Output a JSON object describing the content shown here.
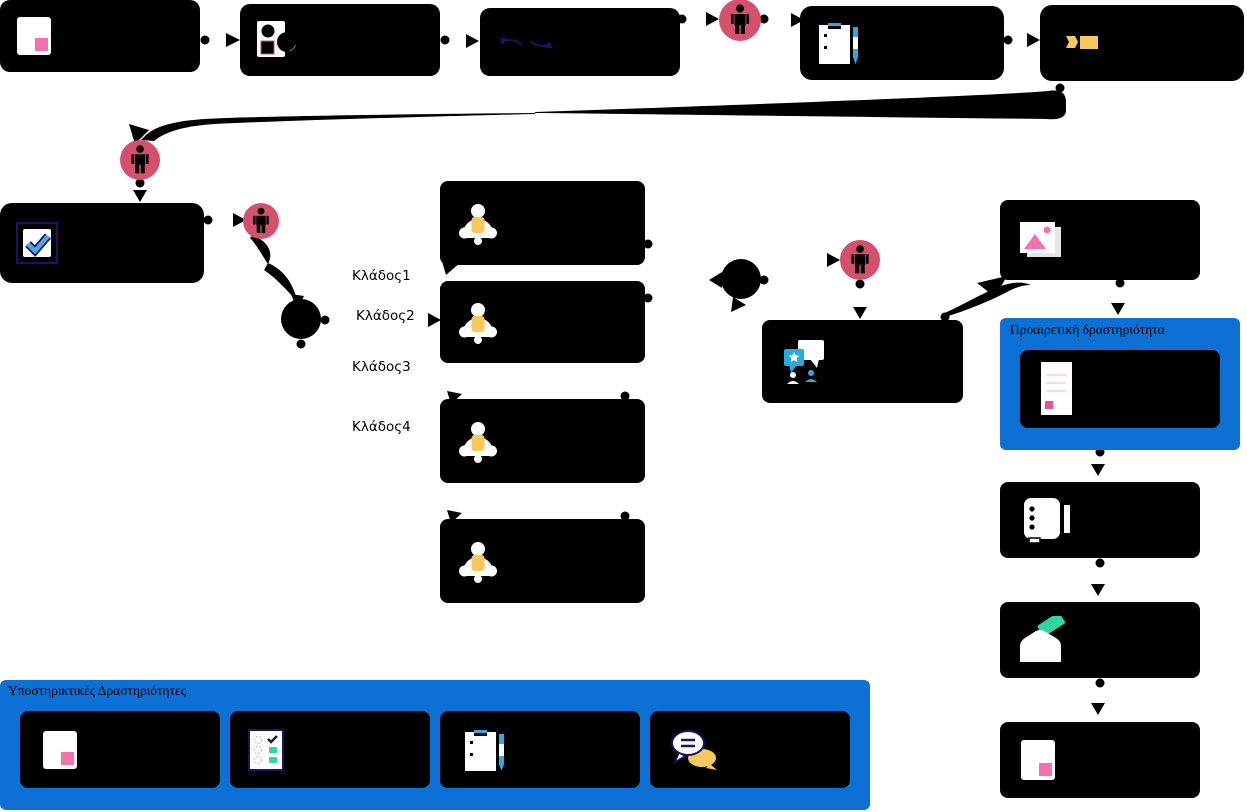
{
  "diagram": {
    "kind": "process-flowchart",
    "background": "#ffffff"
  },
  "branches": {
    "labels": [
      "Κλάδος1",
      "Κλάδος2",
      "Κλάδος3",
      "Κλάδος4"
    ]
  },
  "optional_activity": {
    "title": "Προαιρετική δραστηριότητα"
  },
  "support_activities": {
    "title": "Υποστηρικτικές Δραστηριότητες"
  },
  "colors": {
    "node_black": "#000000",
    "accent_blue": "#0d70d4",
    "person_circle_crimson": "#d5506d",
    "pink": "#f172ad",
    "yellow": "#f8c85c",
    "teal": "#2fd6a4",
    "light_blue": "#35a7e0",
    "navy": "#1b1464",
    "white": "#ffffff"
  },
  "icons": {
    "top_row": [
      "pink-note-icon",
      "shapes-icon",
      "sync-arrows-icon",
      "person-icon",
      "clipboard-pencil-icon",
      "tag-icon"
    ],
    "middle_flow": [
      "person-icon",
      "check-stamp-icon",
      "person-icon",
      "gateway-circle",
      "bell-icon",
      "bell-icon",
      "bell-icon",
      "bell-icon",
      "gateway-circle",
      "person-icon",
      "chat-people-icon"
    ],
    "right_column": [
      "photo-icon",
      "document-icon",
      "notebook-icon",
      "envelope-card-icon",
      "pink-note-icon"
    ],
    "support_row": [
      "pink-note-icon",
      "checklist-icon",
      "clipboard-pencil-icon",
      "chat-bubbles-icon"
    ]
  }
}
